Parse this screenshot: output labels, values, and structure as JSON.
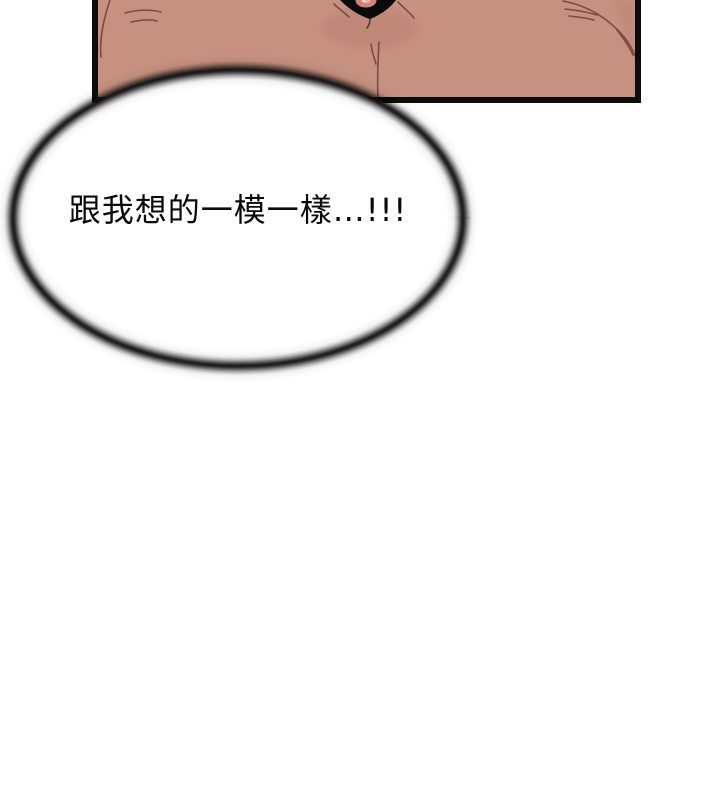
{
  "page": {
    "speech_bubble": {
      "text": "跟我想的一模一樣…!!!"
    },
    "colors": {
      "background": "#ffffff",
      "panel_border": "#0c0c0c",
      "skin": "#c79181",
      "crease": "#6a4138",
      "cleavage_shape": "#0a0a0a",
      "areola": "#d2837b",
      "areola_inner": "#eeb0a5",
      "bubble_fill": "#ffffff",
      "bubble_ring": "#111111",
      "text": "#0a0a0a"
    }
  }
}
